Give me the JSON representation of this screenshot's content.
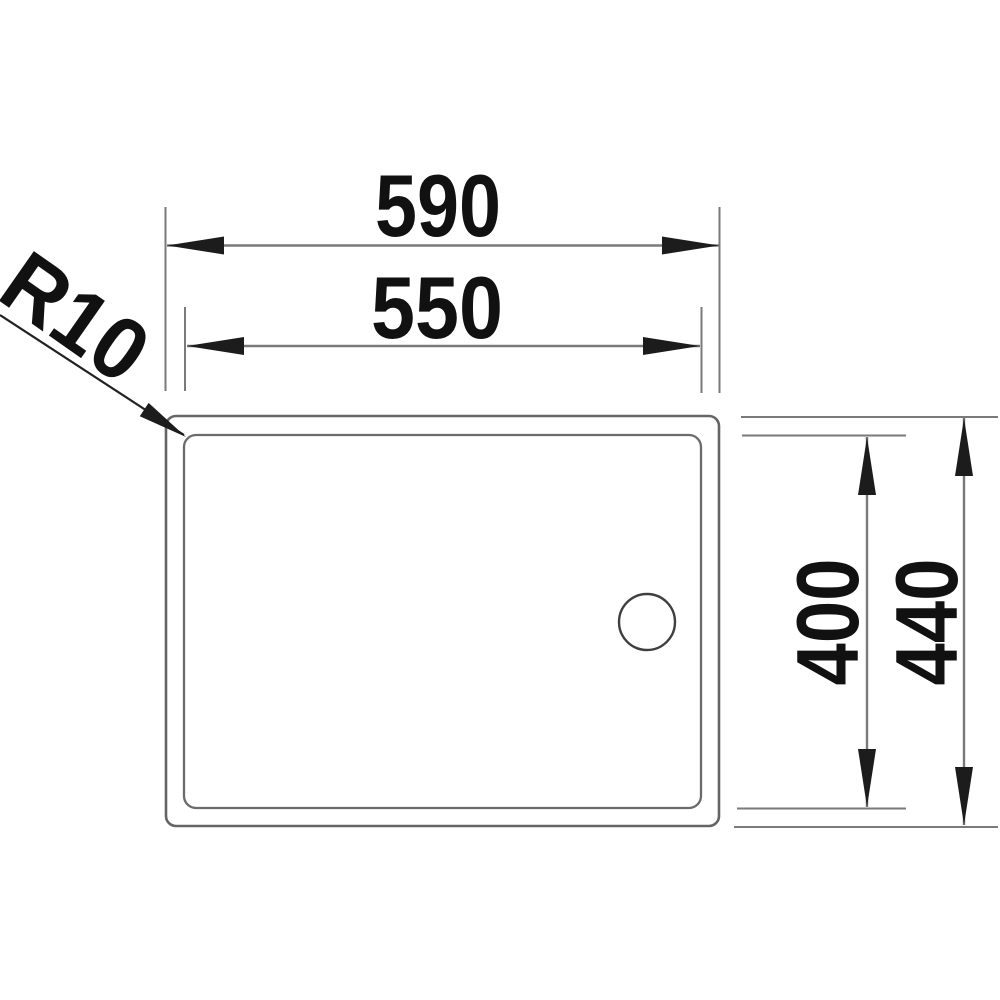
{
  "drawing": {
    "title": "Sink top view technical drawing",
    "view": "top-view-with-dimensions",
    "labels": {
      "outer_width": "590",
      "inner_width": "550",
      "inner_height": "400",
      "outer_height": "440",
      "corner_radius": "R10"
    },
    "units": "mm",
    "colors": {
      "background": "#ffffff",
      "dimension_line": "#7a7a7a",
      "outline": "#656565",
      "text": "#111111",
      "arrow": "#1c1c1c"
    }
  }
}
